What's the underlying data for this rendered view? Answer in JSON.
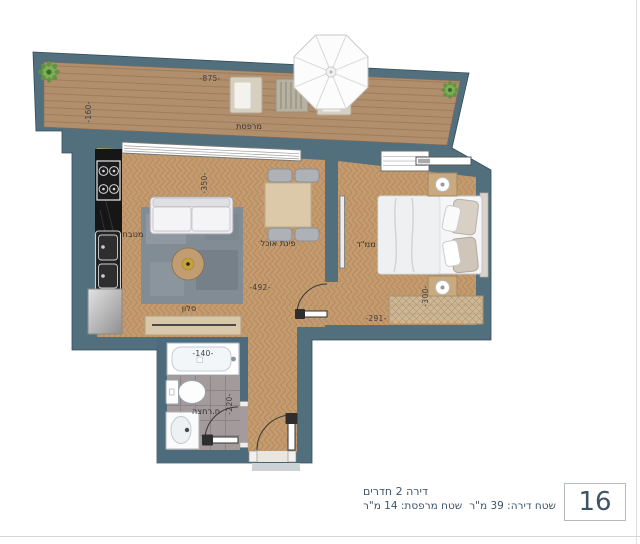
{
  "colors": {
    "wall": "#4d6b7a",
    "deck_wood": "#b18e6c",
    "floor_wood": "#c49b6e",
    "bathroom_tile": "#a39a9c",
    "kitchen_counter": "#161616",
    "info_text": "#3e5469",
    "label_text": "#3a3a3a"
  },
  "rooms": {
    "balcony": "מרפסת",
    "kitchen": "מטבח",
    "living": "סלון",
    "dining": "פינת אוכל",
    "saferoom": "ממ\"ד",
    "bathroom": "ח.רחצה"
  },
  "dimensions": {
    "balcony_width": "-875-",
    "balcony_depth": "-160-",
    "living_width": "-350-",
    "living_depth": "-492-",
    "saferoom_depth": "-300-",
    "saferoom_width": "-291-",
    "bathtub_width": "-140-",
    "bathroom_depth": "-220-"
  },
  "info": {
    "unit_number": "16",
    "line1": "דירה 2 חדרים",
    "line2_part1": "שטח דירה: 39 מ\"ר",
    "line2_part2": "שטח מרפסת: 14 מ\"ר"
  }
}
